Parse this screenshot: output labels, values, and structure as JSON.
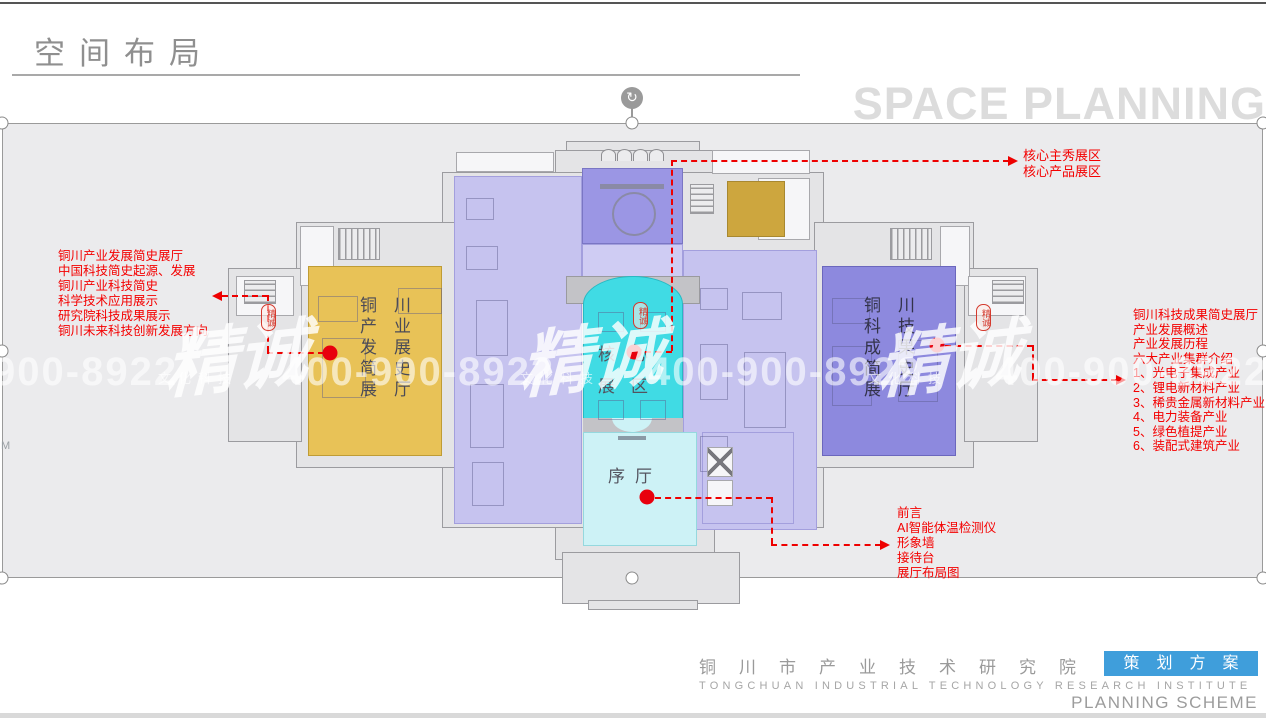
{
  "header": {
    "title": "空间布局",
    "subtitle": "SPACE PLANNING"
  },
  "plan": {
    "zones": {
      "left_wing": {
        "name": "铜川产业发展简史展厅",
        "columns": [
          "铜产发简展",
          "川业展史厅"
        ],
        "color": "#E8C257"
      },
      "right_wing": {
        "name": "铜川科技成果简史展厅",
        "columns": [
          "铜科成简展",
          "川技果史厅"
        ],
        "color": "#8D89DE"
      },
      "core": {
        "name": "核心展区",
        "rows": [
          "核心",
          "展区"
        ],
        "color": "#40DBE4"
      },
      "foyer": {
        "name": "序厅",
        "color": "#CDF2F6"
      },
      "stage_color": "#9B96E4",
      "hall_color": "#C6C3EF",
      "gold_room_color": "#CDA63E"
    }
  },
  "annotations": {
    "color": "#F40000",
    "top_right": {
      "lines": [
        "核心主秀展区",
        "核心产品展区"
      ]
    },
    "left": {
      "lines": [
        "铜川产业发展简史展厅",
        "中国科技简史起源、发展",
        "铜川产业科技简史",
        "科学技术应用展示",
        "研究院科技成果展示",
        "铜川未来科技创新发展方向"
      ]
    },
    "right": {
      "lines": [
        "铜川科技成果简史展厅",
        "产业发展概述",
        "产业发展历程",
        "六大产业集群介绍",
        "1、光电子集成产业",
        "2、锂电新材料产业",
        "3、稀贵金属新材料产业",
        "4、电力装备产业",
        "5、绿色植提产业",
        "6、装配式建筑产业"
      ]
    },
    "bottom_right": {
      "lines": [
        "前言",
        "AI智能体温检测仪",
        "形象墙",
        "接待台",
        "展厅布局图"
      ]
    }
  },
  "watermark": {
    "brand": "精诚",
    "phone": "400-900-8922",
    "tagline": "文化科技",
    "seal_text": "精诚",
    "m_mark": "M"
  },
  "footer": {
    "org_cn": "铜川市产业技术研究院",
    "badge": "策划方案",
    "badge_color": "#3F9EDB",
    "org_en": "TONGCHUAN INDUSTRIAL TECHNOLOGY RESEARCH INSTITUTE",
    "scheme_en": "PLANNING SCHEME"
  }
}
